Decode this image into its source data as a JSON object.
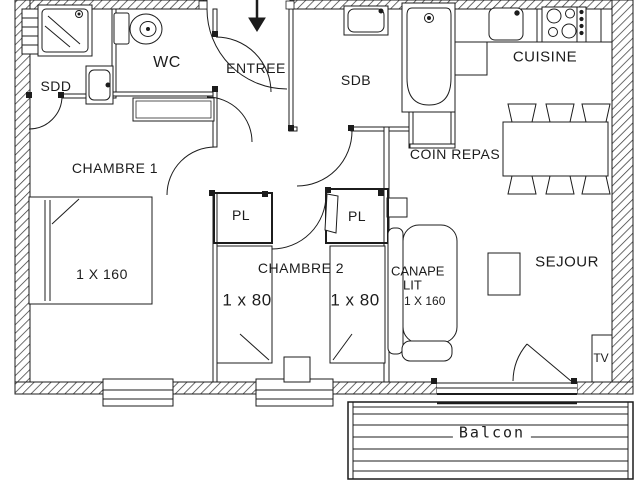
{
  "colors": {
    "line": "#1c1c1c",
    "background": "#ffffff"
  },
  "rooms": {
    "sdd": "SDD",
    "wc": "WC",
    "entree": "ENTREE",
    "sdb": "SDB",
    "cuisine": "CUISINE",
    "coin_repas": "COIN REPAS",
    "chambre1": "CHAMBRE 1",
    "pl_left": "PL",
    "pl_right": "PL",
    "chambre2": "CHAMBRE 2",
    "sejour": "SEJOUR",
    "balcon": "Balcon"
  },
  "furniture": {
    "bed_double_label": "1 X 160",
    "bed_single_left_label": "1 x 80",
    "bed_single_right_label": "1 x 80",
    "sofa_line1": "CANAPE",
    "sofa_line2": "LIT",
    "sofa_line3": "1 X 160",
    "tv_label": "TV"
  }
}
